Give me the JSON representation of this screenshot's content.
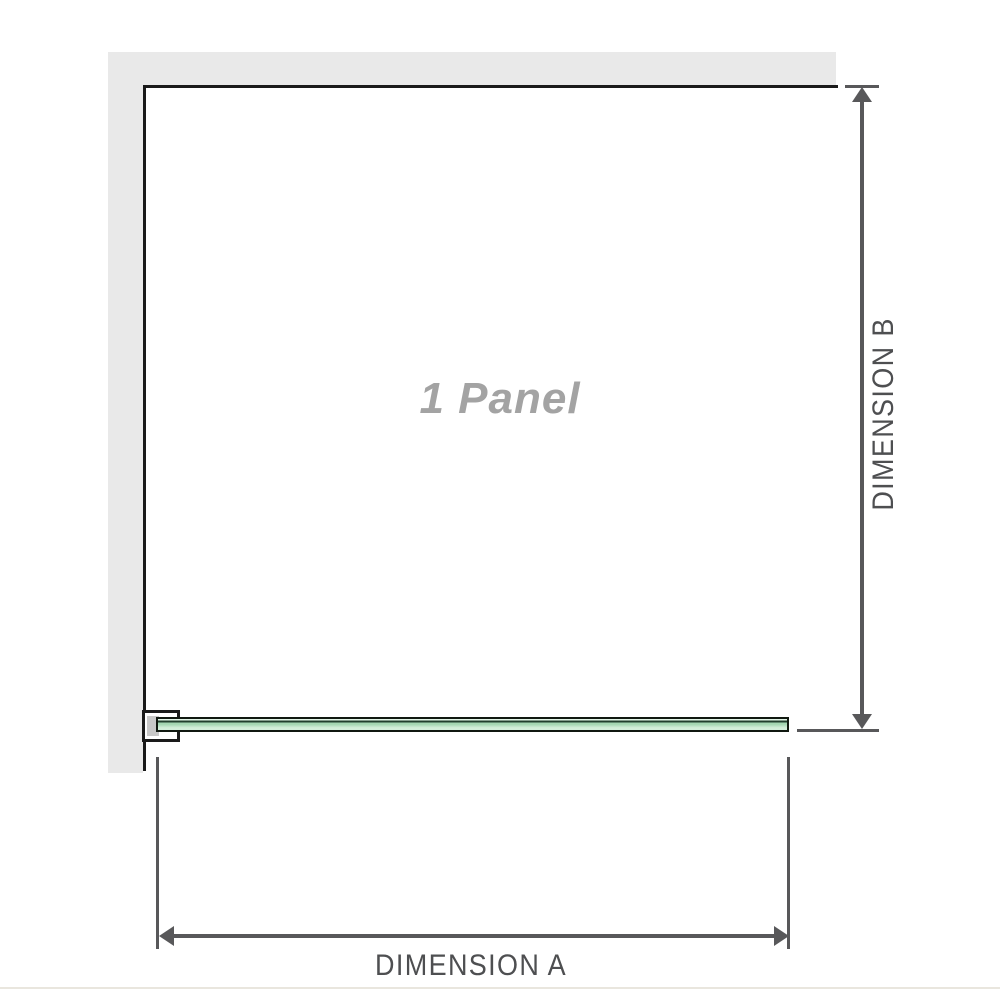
{
  "diagram": {
    "panel_label": "1 Panel",
    "dimension_a": {
      "label": "DIMENSION A"
    },
    "dimension_b": {
      "label": "DIMENSION B"
    },
    "colors": {
      "wall": "#e9e9e9",
      "outline": "#1a1a1a",
      "dimension": "#58585a",
      "label_text": "#4e4f51",
      "panel_text": "#a3a3a3",
      "bracket_metal": "#c8c8c8",
      "glass_outline": "#101810",
      "glass_highlight": "#e2f5e7",
      "glass_dark": "#213e2d",
      "glass_mid": "#a4d6b2",
      "glass_light": "#d3eeda",
      "baseline": "#e9e6de"
    }
  }
}
